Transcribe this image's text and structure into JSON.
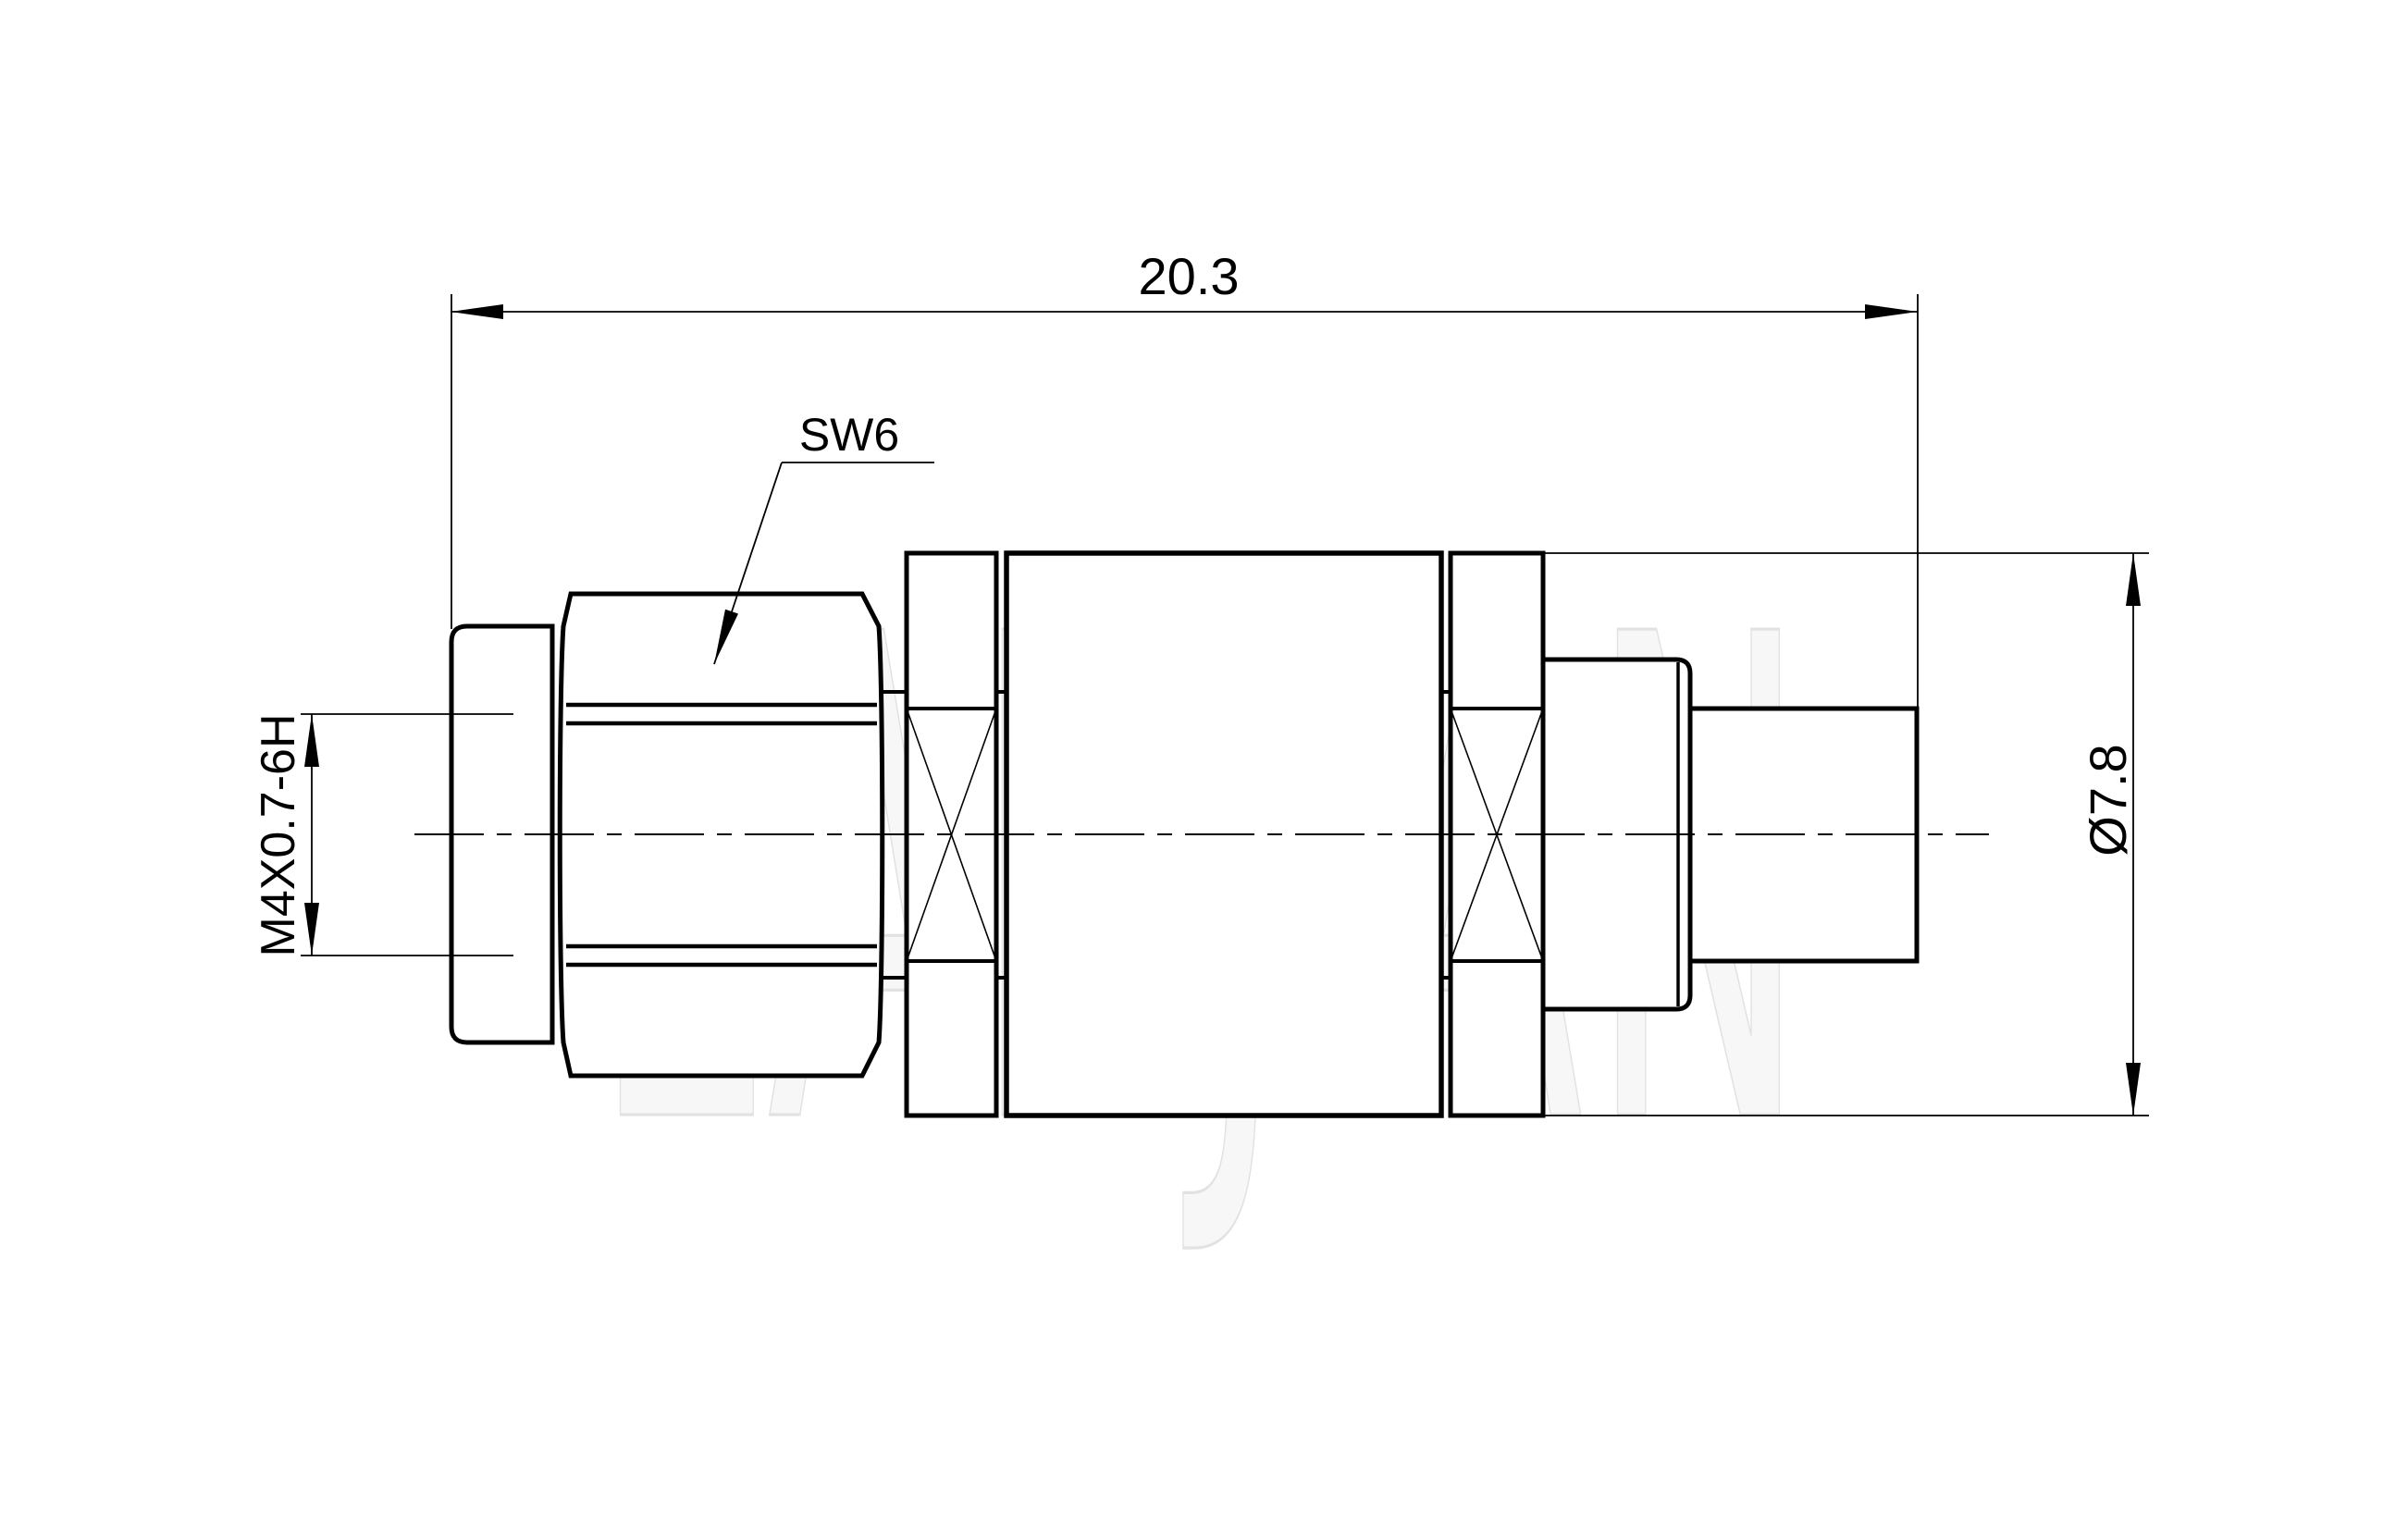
{
  "watermark": {
    "text": "LANJIAN"
  },
  "dimensions": {
    "overall_length": "20.3",
    "outer_diameter": "Ø7.8",
    "thread_spec": "M4X0.7-6H"
  },
  "labels": {
    "hex_size": "SW6"
  },
  "colors": {
    "line": "#000000",
    "background": "#ffffff",
    "watermark": "#e4e4e4"
  }
}
